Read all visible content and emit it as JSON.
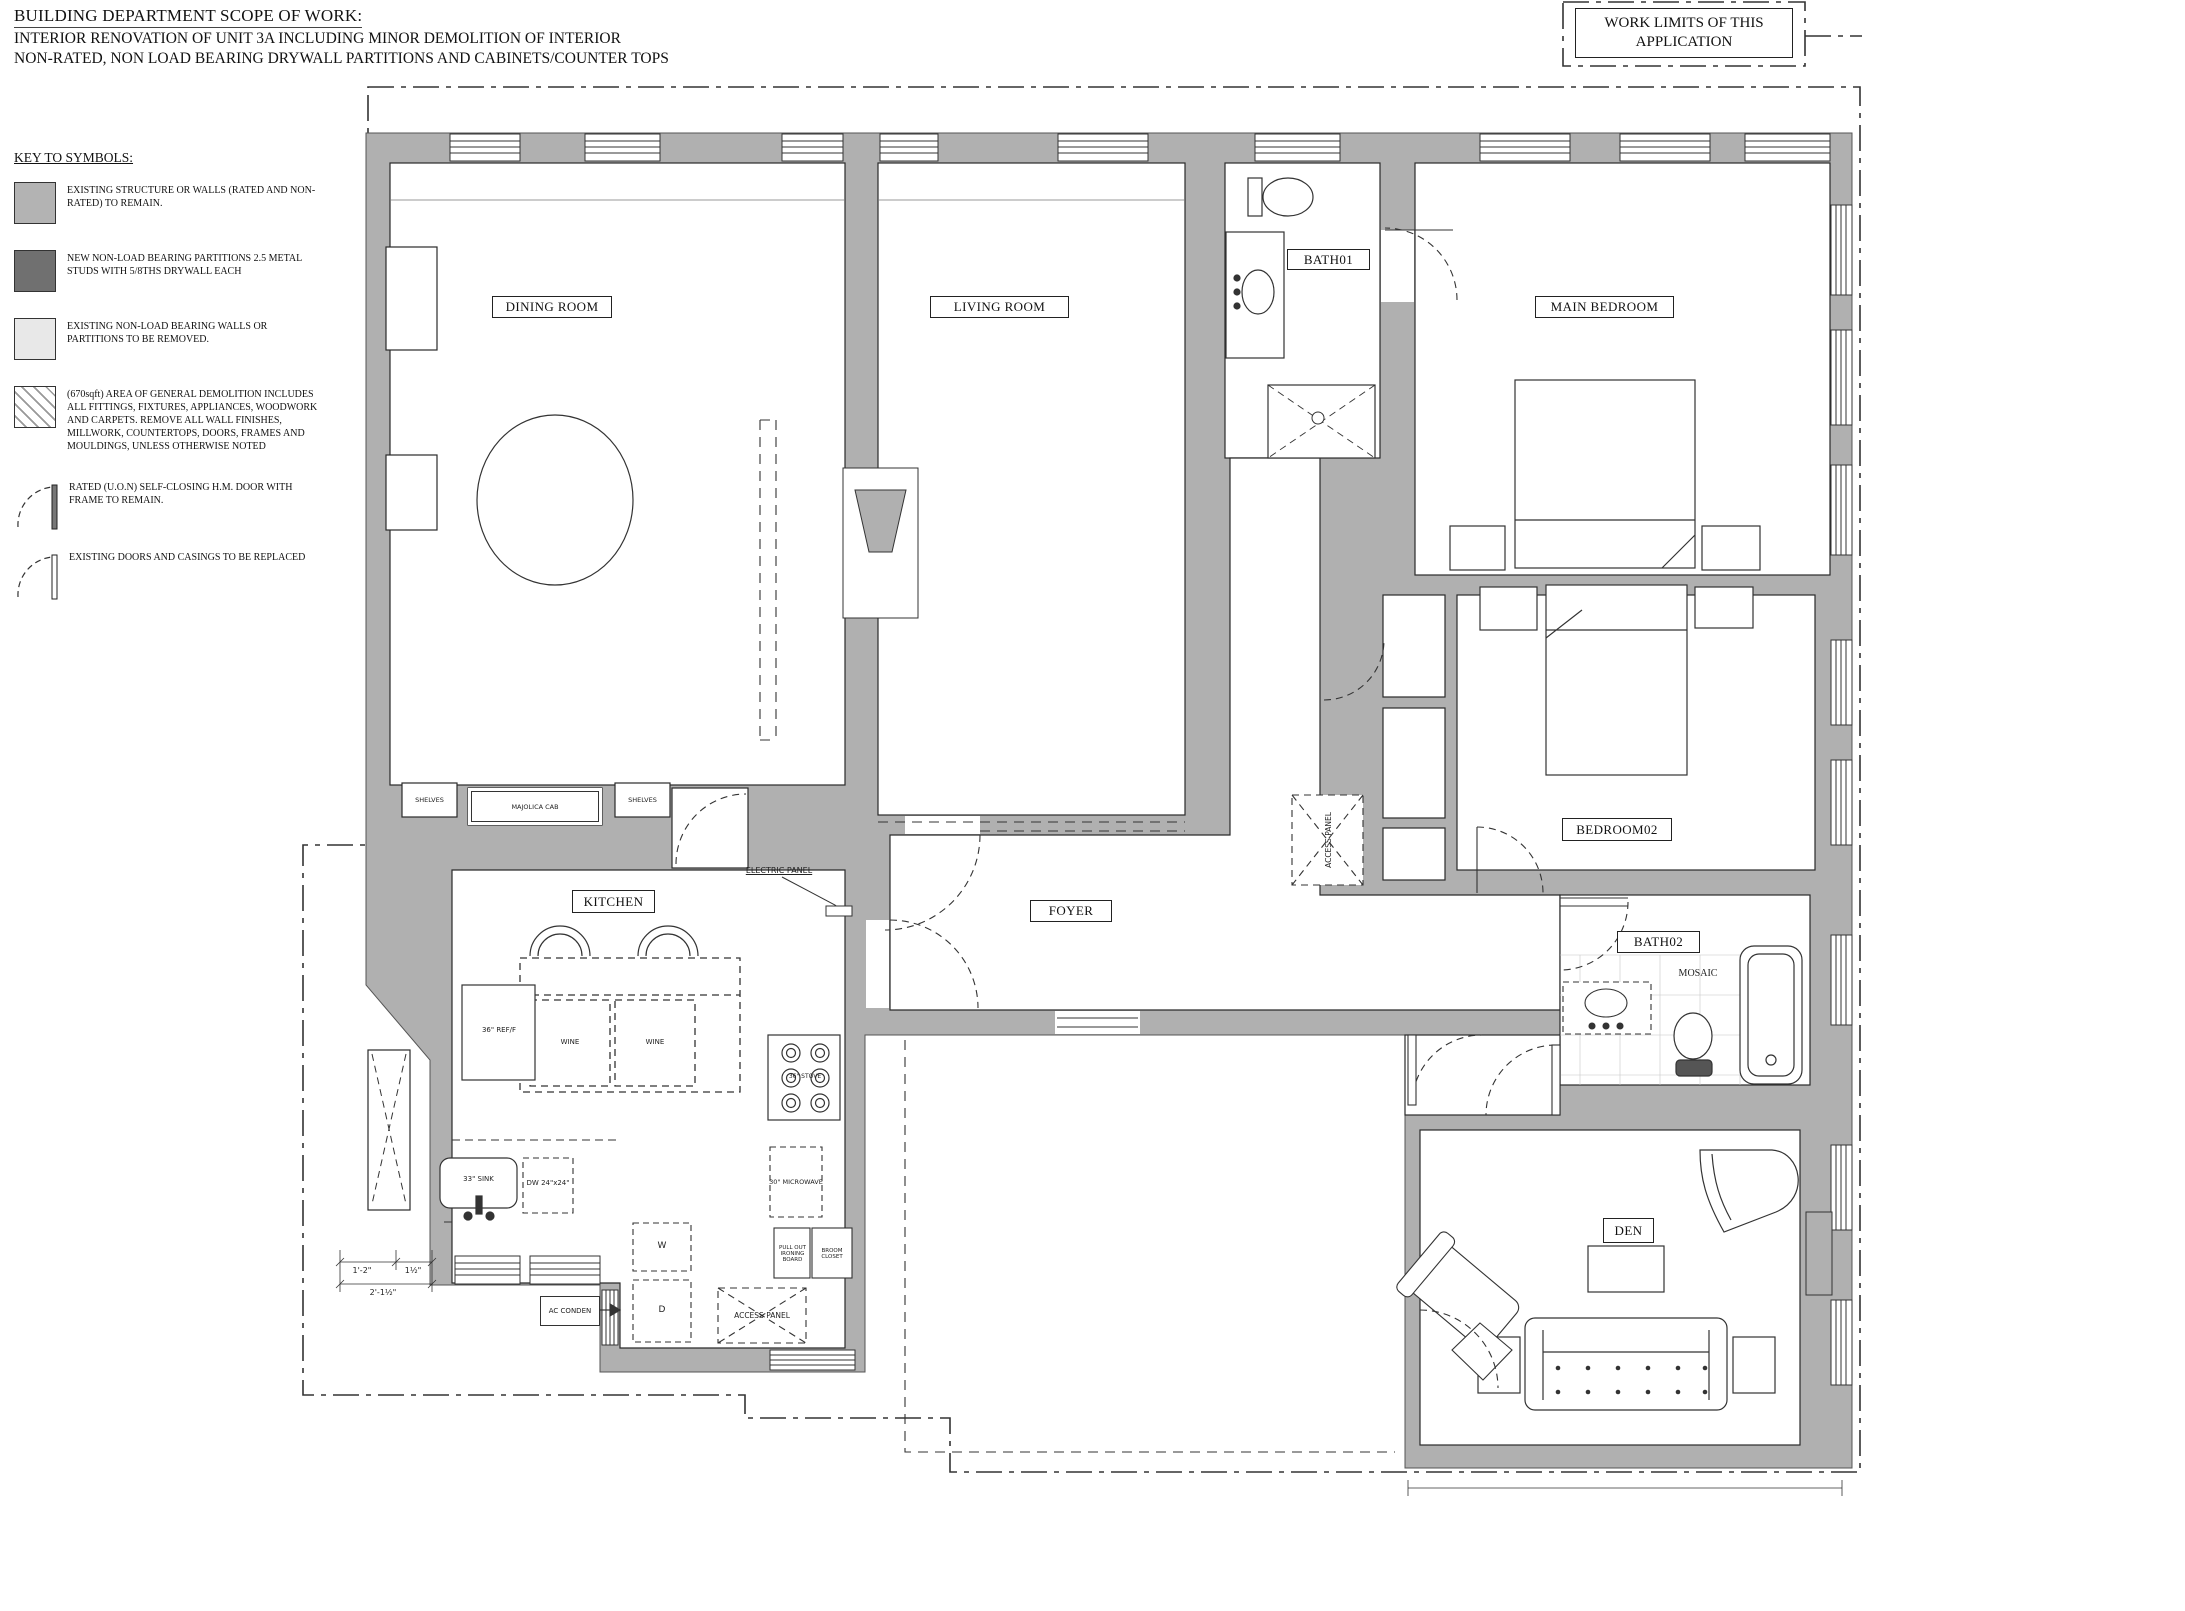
{
  "titles": {
    "line1": "BUILDING DEPARTMENT SCOPE OF WORK:",
    "line2": "INTERIOR RENOVATION OF UNIT 3A INCLUDING MINOR DEMOLITION OF INTERIOR",
    "line3": "NON-RATED, NON LOAD BEARING DRYWALL PARTITIONS AND CABINETS/COUNTER TOPS"
  },
  "work_limits": {
    "label": "WORK LIMITS OF THIS APPLICATION"
  },
  "legend": {
    "heading": "KEY TO SYMBOLS:",
    "items": [
      {
        "symbol": "existing-structure-swatch",
        "color": "#b3b3b3",
        "text": "EXISTING STRUCTURE OR WALLS (RATED AND NON-RATED) TO REMAIN."
      },
      {
        "symbol": "new-partition-swatch",
        "color": "#707070",
        "text": "NEW NON-LOAD BEARING PARTITIONS 2.5 METAL STUDS WITH 5/8THS DRYWALL EACH"
      },
      {
        "symbol": "removed-partition-swatch",
        "color": "#e8e8e8",
        "text": "EXISTING NON-LOAD BEARING WALLS OR PARTITIONS TO BE REMOVED."
      },
      {
        "symbol": "demolition-hatch-swatch",
        "color": "hatch",
        "text": "(670sqft) AREA OF GENERAL DEMOLITION INCLUDES ALL FITTINGS, FIXTURES, APPLIANCES, WOODWORK AND CARPETS. REMOVE ALL WALL FINISHES, MILLWORK, COUNTERTOPS, DOORS, FRAMES AND MOULDINGS, UNLESS OTHERWISE NOTED"
      },
      {
        "symbol": "rated-door-symbol",
        "color": "",
        "text": "RATED (U.O.N) SELF-CLOSING H.M. DOOR WITH FRAME TO REMAIN."
      },
      {
        "symbol": "existing-door-symbol",
        "color": "",
        "text": "EXISTING DOORS AND CASINGS TO BE REPLACED"
      }
    ]
  },
  "rooms": {
    "dining": "DINING ROOM",
    "living": "LIVING ROOM",
    "bath01": "BATH01",
    "main_bedroom": "MAIN BEDROOM",
    "bedroom02": "BEDROOM02",
    "kitchen": "KITCHEN",
    "foyer": "FOYER",
    "bath02": "BATH02",
    "den": "DEN"
  },
  "annotations": {
    "shelves_left": "SHELVES",
    "shelves_right": "SHELVES",
    "majolica_cab": "MAJOLICA CAB",
    "electric_panel": "ELECTRIC PANEL",
    "refrigerator": "36\" REF/F",
    "wine_left": "WINE",
    "wine_right": "WINE",
    "sink_33": "33\" SINK",
    "dishwasher": "DW 24\"x24\"",
    "stove": "36\" STOVE",
    "microwave": "30\" MICROWAVE",
    "washer": "W",
    "dryer": "D",
    "ac_condenser": "AC CONDEN",
    "ironing_board": "PULL OUT IRONING BOARD",
    "broom_closet": "BROOM CLOSET",
    "access_panel_kitchen": "ACCESS PANEL",
    "access_panel_shaft": "ACCESS PANEL",
    "mosaic": "MOSAIC"
  },
  "dimensions": {
    "d1": "1'-2\"",
    "d2": "1½\"",
    "d3": "2'-1½\""
  },
  "colors": {
    "wall_existing": "#b0b0b0",
    "wall_new": "#707070",
    "wall_removed": "#e8e8e8",
    "line": "#222222"
  }
}
